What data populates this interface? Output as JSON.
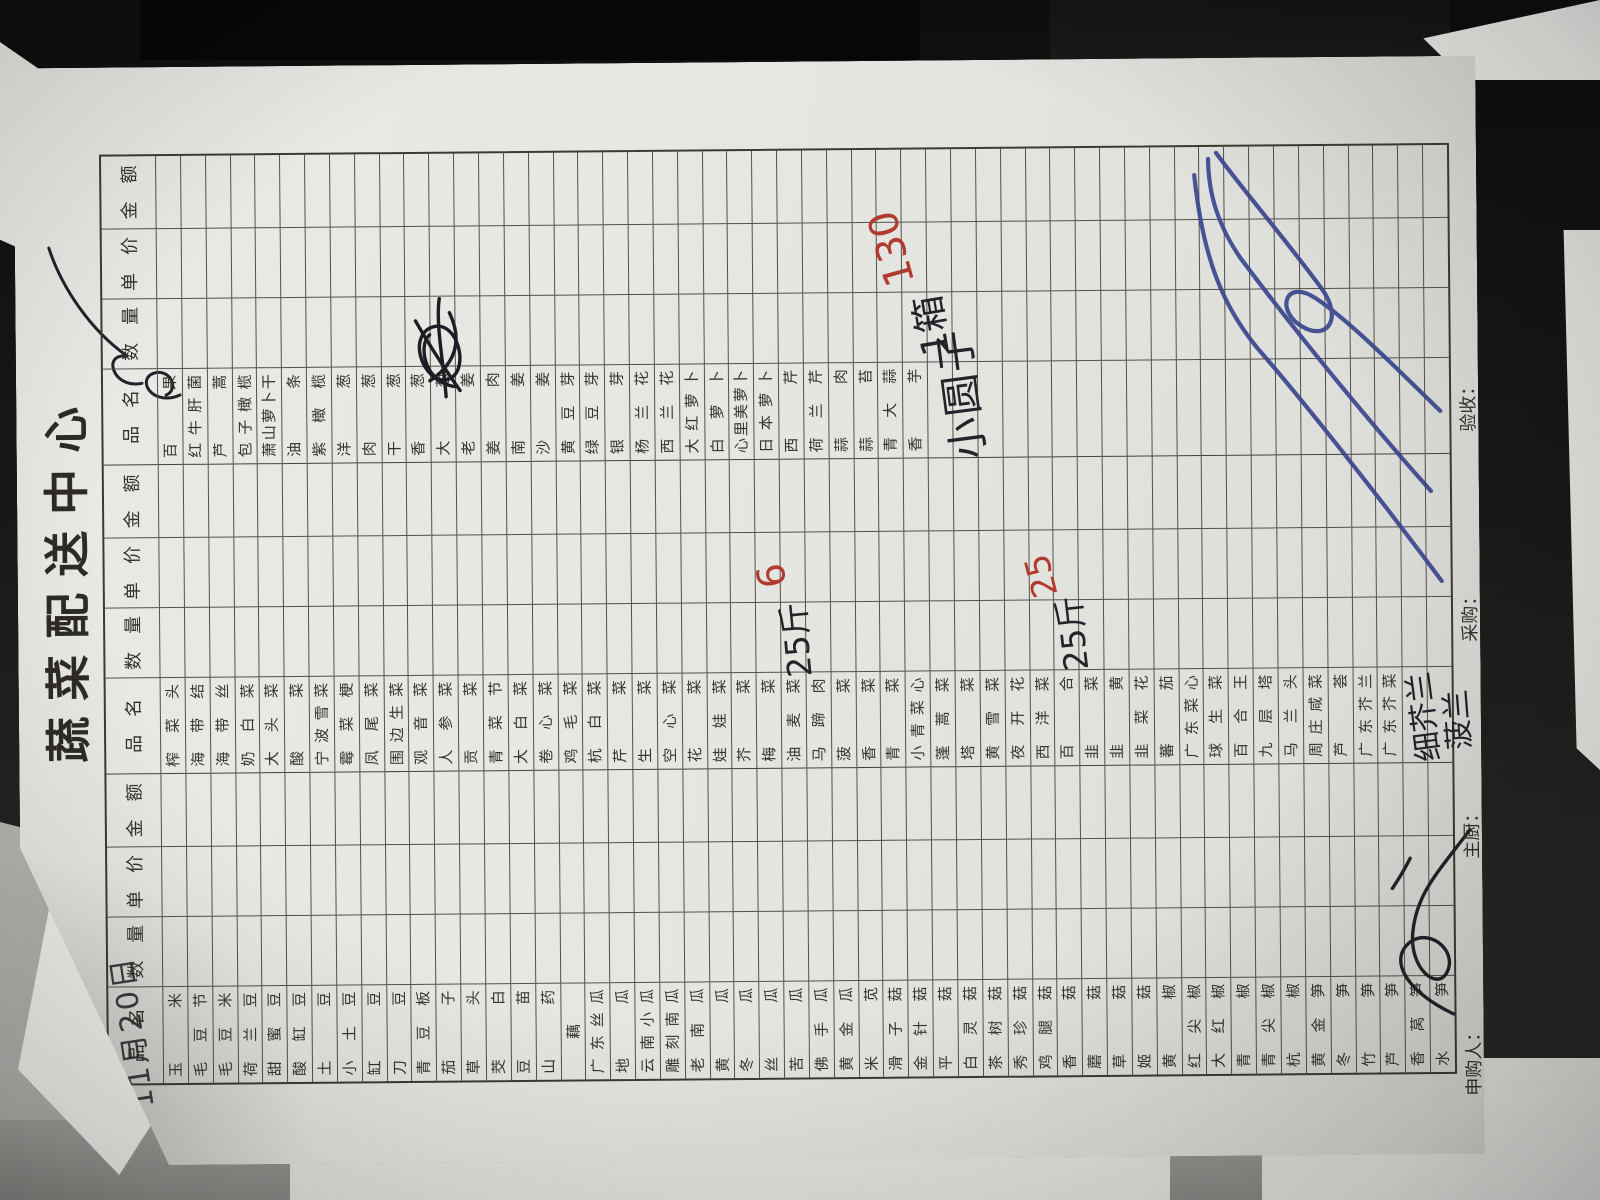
{
  "form": {
    "title": "蔬菜配送中心",
    "handwritten_date": "11月20日",
    "column_headers": [
      "品　名",
      "数　量",
      "单　价",
      "金　额"
    ],
    "row_count": 52,
    "groups": [
      {
        "items": [
          "玉米",
          "毛豆节",
          "毛豆米",
          "荷兰豆",
          "甜蜜豆",
          "酸缸豆",
          "土豆",
          "小土豆",
          "缸豆",
          "刀豆",
          "青豆板",
          "茄子",
          "草头",
          "茭白",
          "豆苗",
          "山药",
          "藕",
          "广东丝瓜",
          "地瓜",
          "云南小瓜",
          "雕刻南瓜",
          "老南瓜",
          "黄瓜",
          "冬瓜",
          "丝瓜",
          "苦瓜",
          "佛手瓜",
          "黄金瓜",
          "米苋",
          "滑子菇",
          "金针菇",
          "平菇",
          "白灵菇",
          "茶树菇",
          "秀珍菇",
          "鸡腿菇",
          "香菇",
          "蘑菇",
          "草菇",
          "姬菇",
          "黄椒",
          "红尖椒",
          "大红椒",
          "青椒",
          "青尖椒",
          "杭椒",
          "黄金笋",
          "冬笋",
          "竹笋",
          "芦笋",
          "香莴笋",
          "水笋"
        ]
      },
      {
        "items": [
          "榨菜头",
          "海带结",
          "海带丝",
          "奶白菜",
          "大头菜",
          "酸菜",
          "宁波雪菜",
          "霉菜梗",
          "凤尾菜",
          "围边生菜",
          "观音菜",
          "人参菜",
          "贡菜",
          "青菜节",
          "大白菜",
          "卷心菜",
          "鸡毛菜",
          "杭白菜",
          "芹菜",
          "生菜",
          "空心菜",
          "花菜",
          "娃娃菜",
          "芥菜",
          "梅菜",
          "油麦菜",
          "马蹄肉",
          "菠菜",
          "香菜",
          "青菜",
          "小青菜心",
          "蓬蒿菜",
          "塔菜",
          "黄雪菜",
          "夜开花",
          "西洋菜",
          "百合",
          "韭菜",
          "韭黄",
          "韭菜花",
          "蕃茄",
          "广东菜心",
          "球生菜",
          "百合王",
          "九层塔",
          "马兰头",
          "周庄咸菜",
          "芦荟",
          "广东芥兰",
          "广东芥菜"
        ]
      },
      {
        "items": [
          "百果",
          "红牛肝菌",
          "芦蒿",
          "包子橄榄",
          "萧山萝卜干",
          "油条",
          "紫橄榄",
          "洋葱",
          "肉葱",
          "干葱",
          "香葱",
          "大葱",
          "老姜",
          "姜肉",
          "南姜",
          "沙姜",
          "黄豆芽",
          "绿豆芽",
          "银芽",
          "杨兰花",
          "西兰花",
          "大红萝卜",
          "白萝卜",
          "心里美萝卜",
          "日本萝卜",
          "西芹",
          "荷兰芹",
          "蒜肉",
          "蒜苔",
          "青大蒜",
          "香芋"
        ]
      }
    ],
    "footer_labels": [
      "申购人：",
      "主厨：",
      "采购：",
      "验收："
    ],
    "handwriting": {
      "group2_row26_qty": "25斤",
      "group2_row26_price": "6",
      "group2_row37_qty": "25斤",
      "group2_row37_price": "25",
      "group3_extra_item": "小圆子",
      "group3_extra_qty": "1箱",
      "group3_extra_price": "130",
      "group2_extra_item_1": "细芥兰",
      "group2_extra_item_2": "菠兰"
    },
    "colors": {
      "paper": "#e7e8e3",
      "grid_line": "#55514a",
      "printed_text": "#38342d",
      "black_ink": "#23232a",
      "red_ink": "#b23a2e",
      "blue_ink": "#3b478f"
    }
  }
}
